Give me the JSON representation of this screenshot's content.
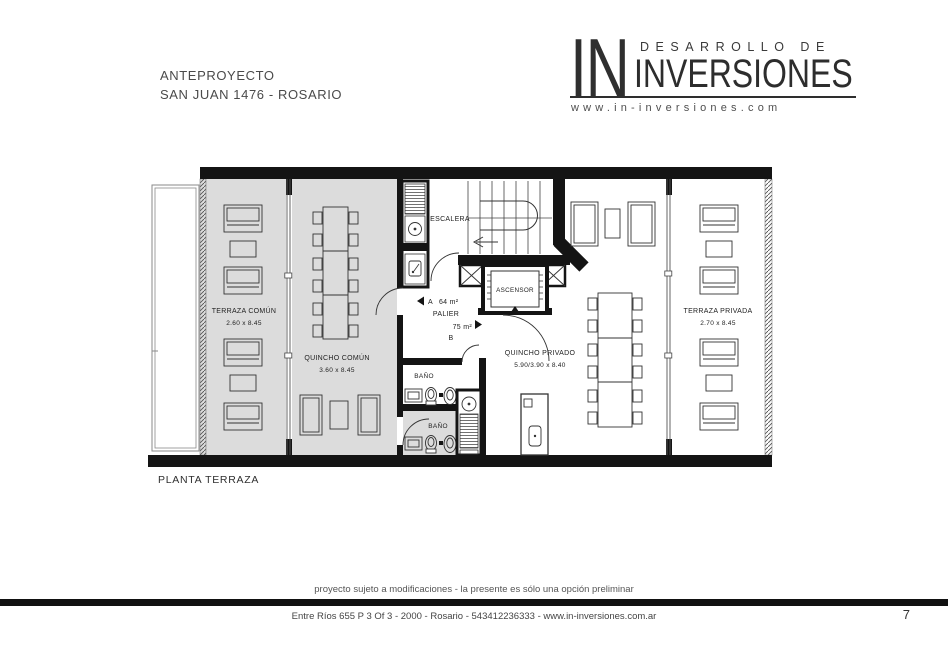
{
  "header": {
    "project": {
      "line1": "ANTEPROYECTO",
      "line2": "SAN JUAN 1476 - ROSARIO"
    }
  },
  "logo": {
    "monogram": "IN",
    "tagline": "DESARROLLO DE",
    "brand": "INVERSIONES",
    "website": "www.in-inversiones.com"
  },
  "plan": {
    "title": "PLANTA TERRAZA",
    "colors": {
      "wall": "#141414",
      "common_area_fill": "#dcdcdc",
      "drawing_line": "#333333"
    },
    "rooms": {
      "terraza_comun": {
        "name": "TERRAZA COMÚN",
        "dims": "2.60 x 8.45"
      },
      "quincho_comun": {
        "name": "QUINCHO COMÚN",
        "dims": "3.60 x 8.45"
      },
      "escalera": {
        "name": "ESCALERA"
      },
      "ascensor": {
        "name": "ASCENSOR"
      },
      "palier": {
        "name": "PALIER"
      },
      "unit_a": {
        "label": "A",
        "area": "64 m²"
      },
      "unit_b": {
        "label": "B",
        "area": "75 m²"
      },
      "bano1": {
        "name": "BAÑO"
      },
      "bano2": {
        "name": "BAÑO"
      },
      "quincho_privado": {
        "name": "QUINCHO PRIVADO",
        "dims": "5.90/3.90 x 8.40"
      },
      "terraza_privada": {
        "name": "TERRAZA PRIVADA",
        "dims": "2.70 x 8.45"
      }
    }
  },
  "footer": {
    "disclaimer": "proyecto sujeto a modificaciones - la presente es sólo una opción preliminar",
    "address": "Entre Ríos 655 P 3 Of 3 - 2000 - Rosario - 543412236333 - www.in-inversiones.com.ar",
    "page": "7"
  }
}
